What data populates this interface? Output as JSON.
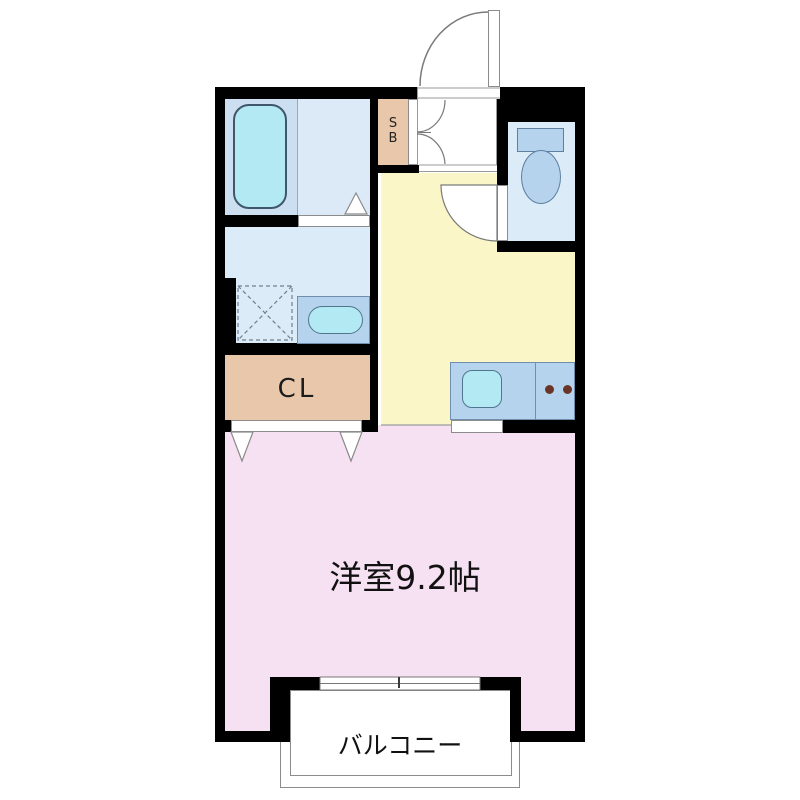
{
  "plan": {
    "type": "apartment-floor-plan",
    "rooms": {
      "western_room_label": "洋室9.2帖",
      "balcony_label": "バルコニー",
      "closet_label": "CL",
      "shoe_box_line1": "S",
      "shoe_box_line2": "B"
    },
    "fixtures": [
      "bathtub",
      "washing-machine-pan",
      "vanity-sink",
      "toilet",
      "kitchen-counter",
      "kitchen-sink",
      "stove-burners",
      "entrance-door-swing",
      "toilet-door-swing",
      "shoebox-double-doors",
      "bathroom-door-opening",
      "closet-folding-doors",
      "sliding-window",
      "balcony"
    ],
    "colors": {
      "wall": "#000000",
      "main_room": "#f6e1f3",
      "kitchen": "#fbf6c8",
      "wet_rooms": "#dcebf8",
      "bath_panel": "#cbdff0",
      "bathtub": "#b3e9f2",
      "fixture_blue": "#b6d3ee",
      "closet_tan": "#e9c7aa",
      "burner": "#6a3526",
      "outline_gray": "#7a7a7a"
    }
  }
}
